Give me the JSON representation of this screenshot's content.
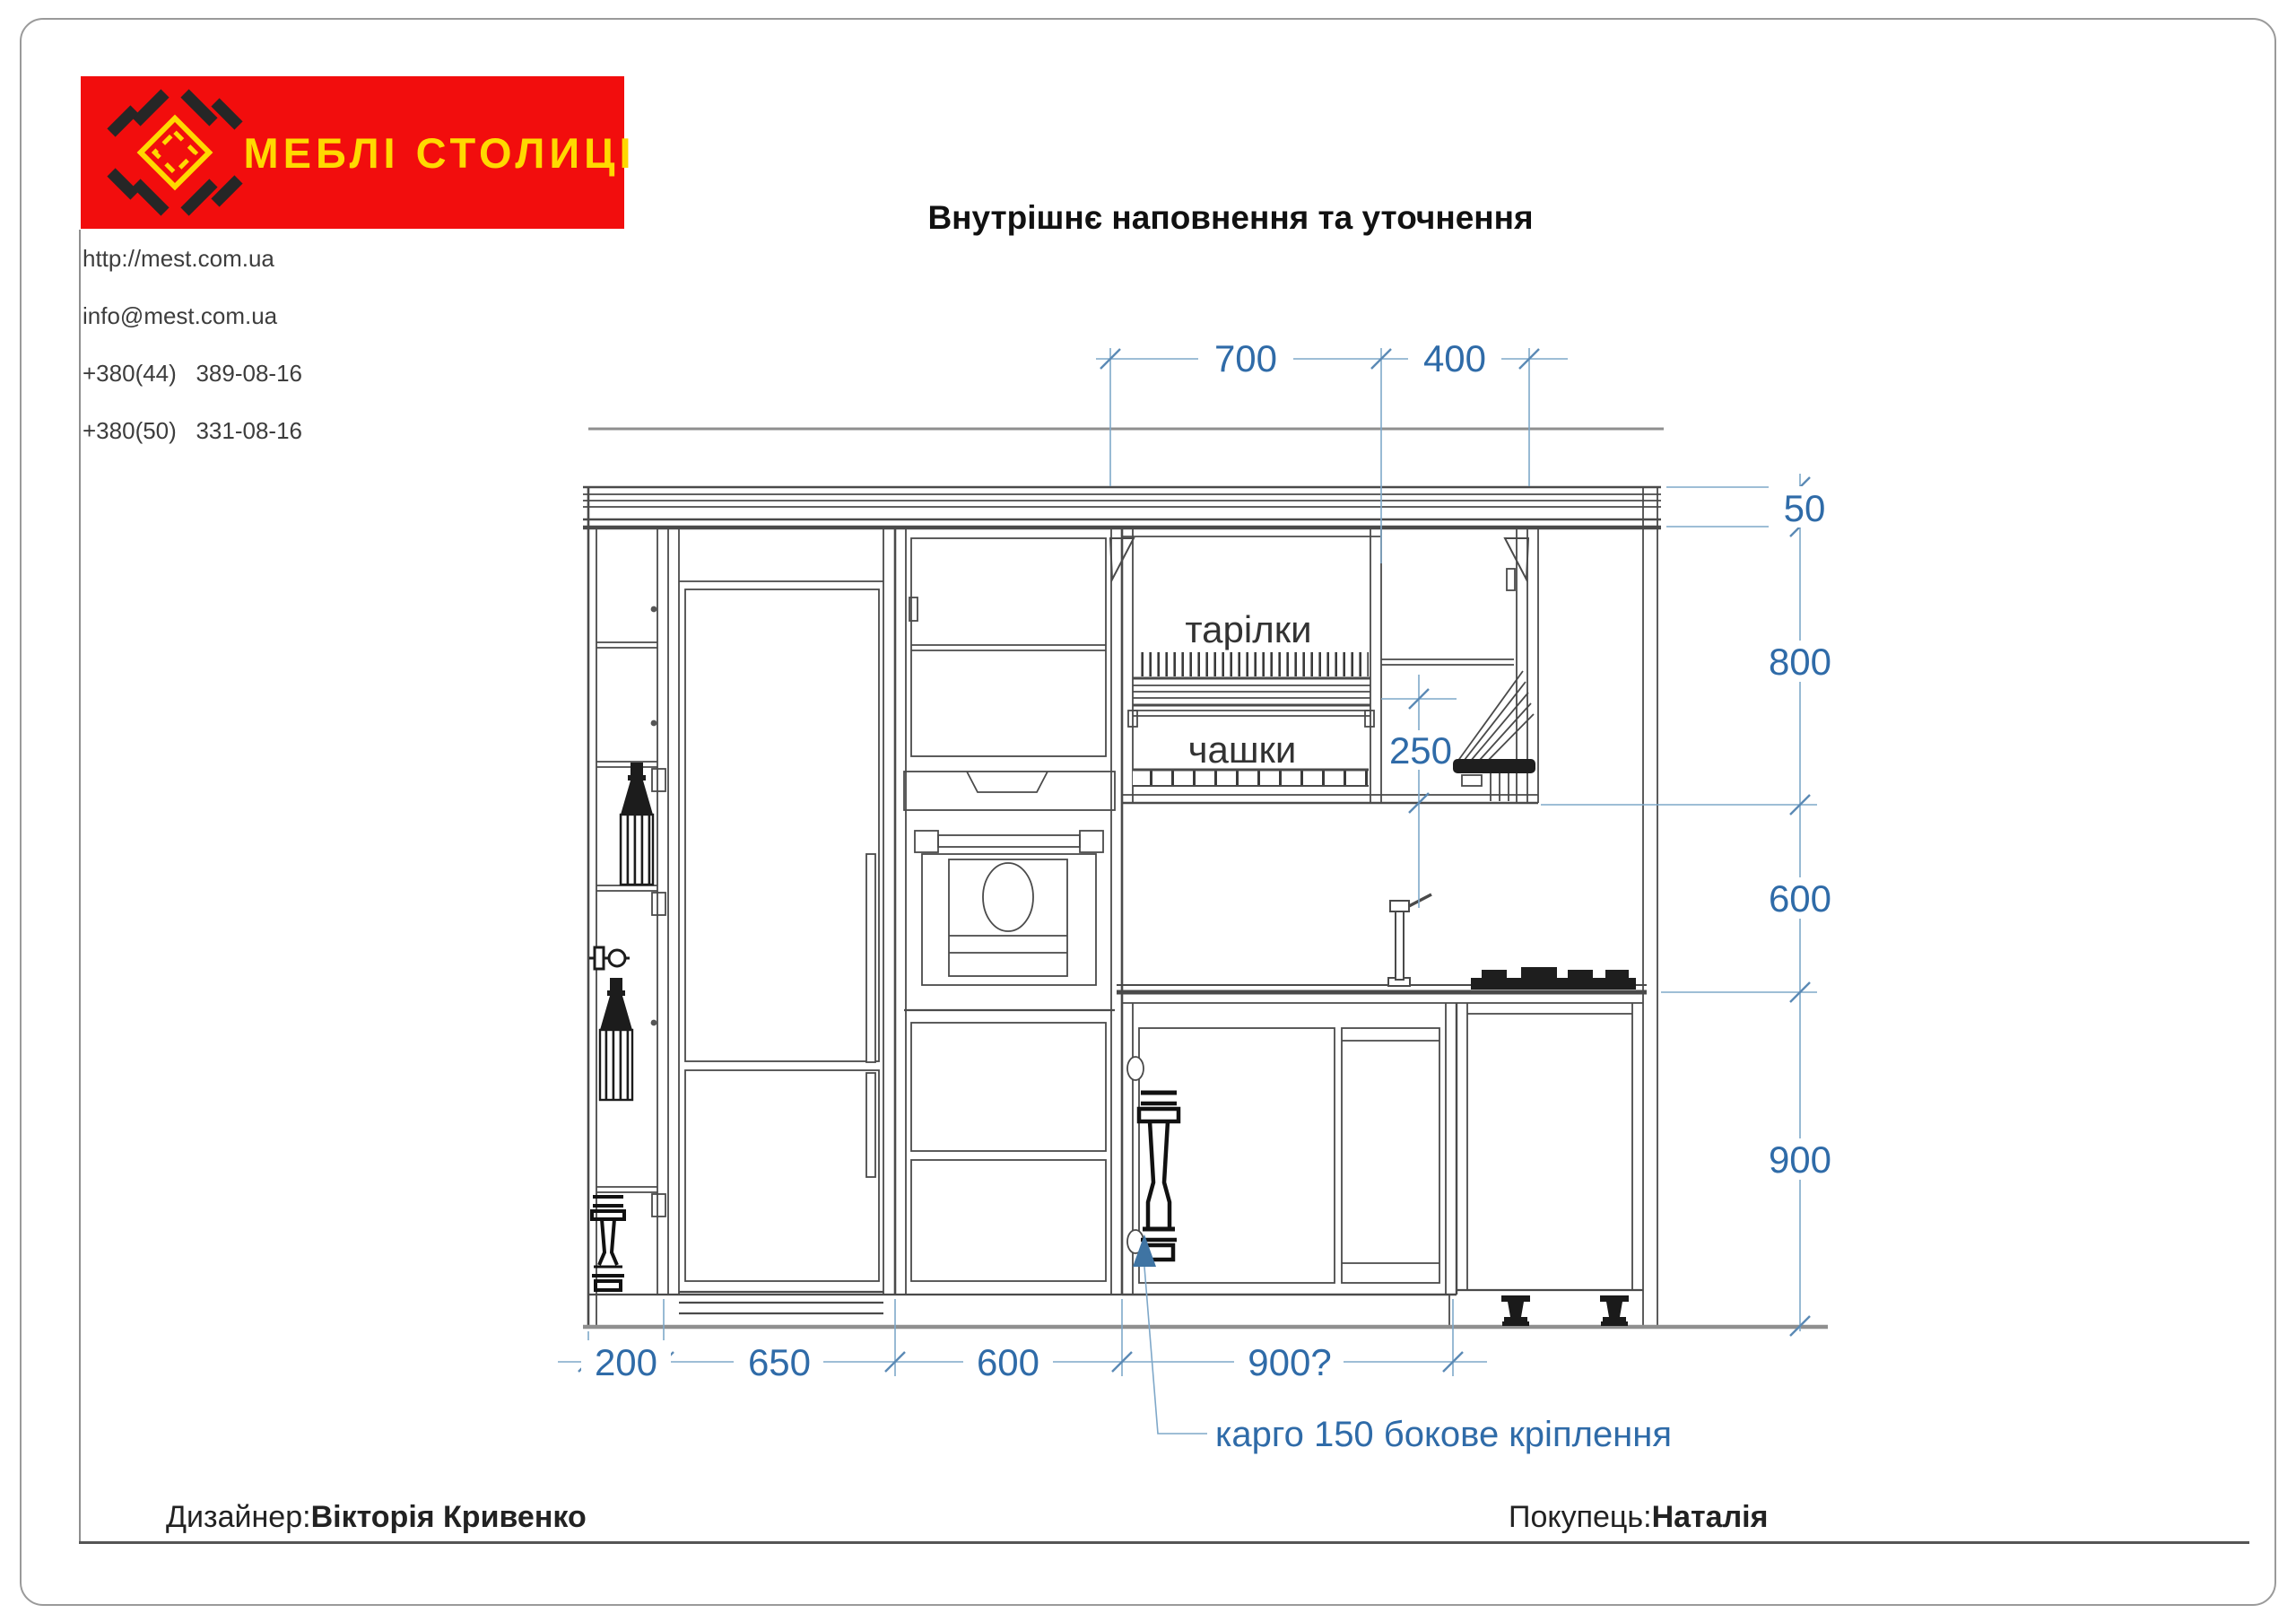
{
  "header": {
    "logo": {
      "brand": "МЕБЛІ СТОЛИЦІ",
      "bg_color": "#f20d0d",
      "accent_color": "#ffd900"
    },
    "contacts": {
      "website": "http://mest.com.ua",
      "email": "info@mest.com.ua",
      "phone1": "+380(44)   389-08-16",
      "phone2": "+380(50)   331-08-16"
    },
    "title": "Внутрішнє наповнення та уточнення"
  },
  "drawing": {
    "labels": {
      "plates": "тарілки",
      "cups": "чашки",
      "cargo_note": "карго 150 бокове кріплення"
    },
    "dims": {
      "top": [
        "700",
        "400"
      ],
      "right": [
        "50",
        "800",
        "600",
        "900"
      ],
      "bottom": [
        "200",
        "650",
        "600",
        "900?"
      ],
      "cups_section": "250"
    },
    "dimension_color": "#2f6ba8"
  },
  "footer": {
    "designer_label": "Дизайнер:",
    "designer_name": "Вікторія Кривенко",
    "customer_label": "Покупець:",
    "customer_name": "Наталія"
  }
}
